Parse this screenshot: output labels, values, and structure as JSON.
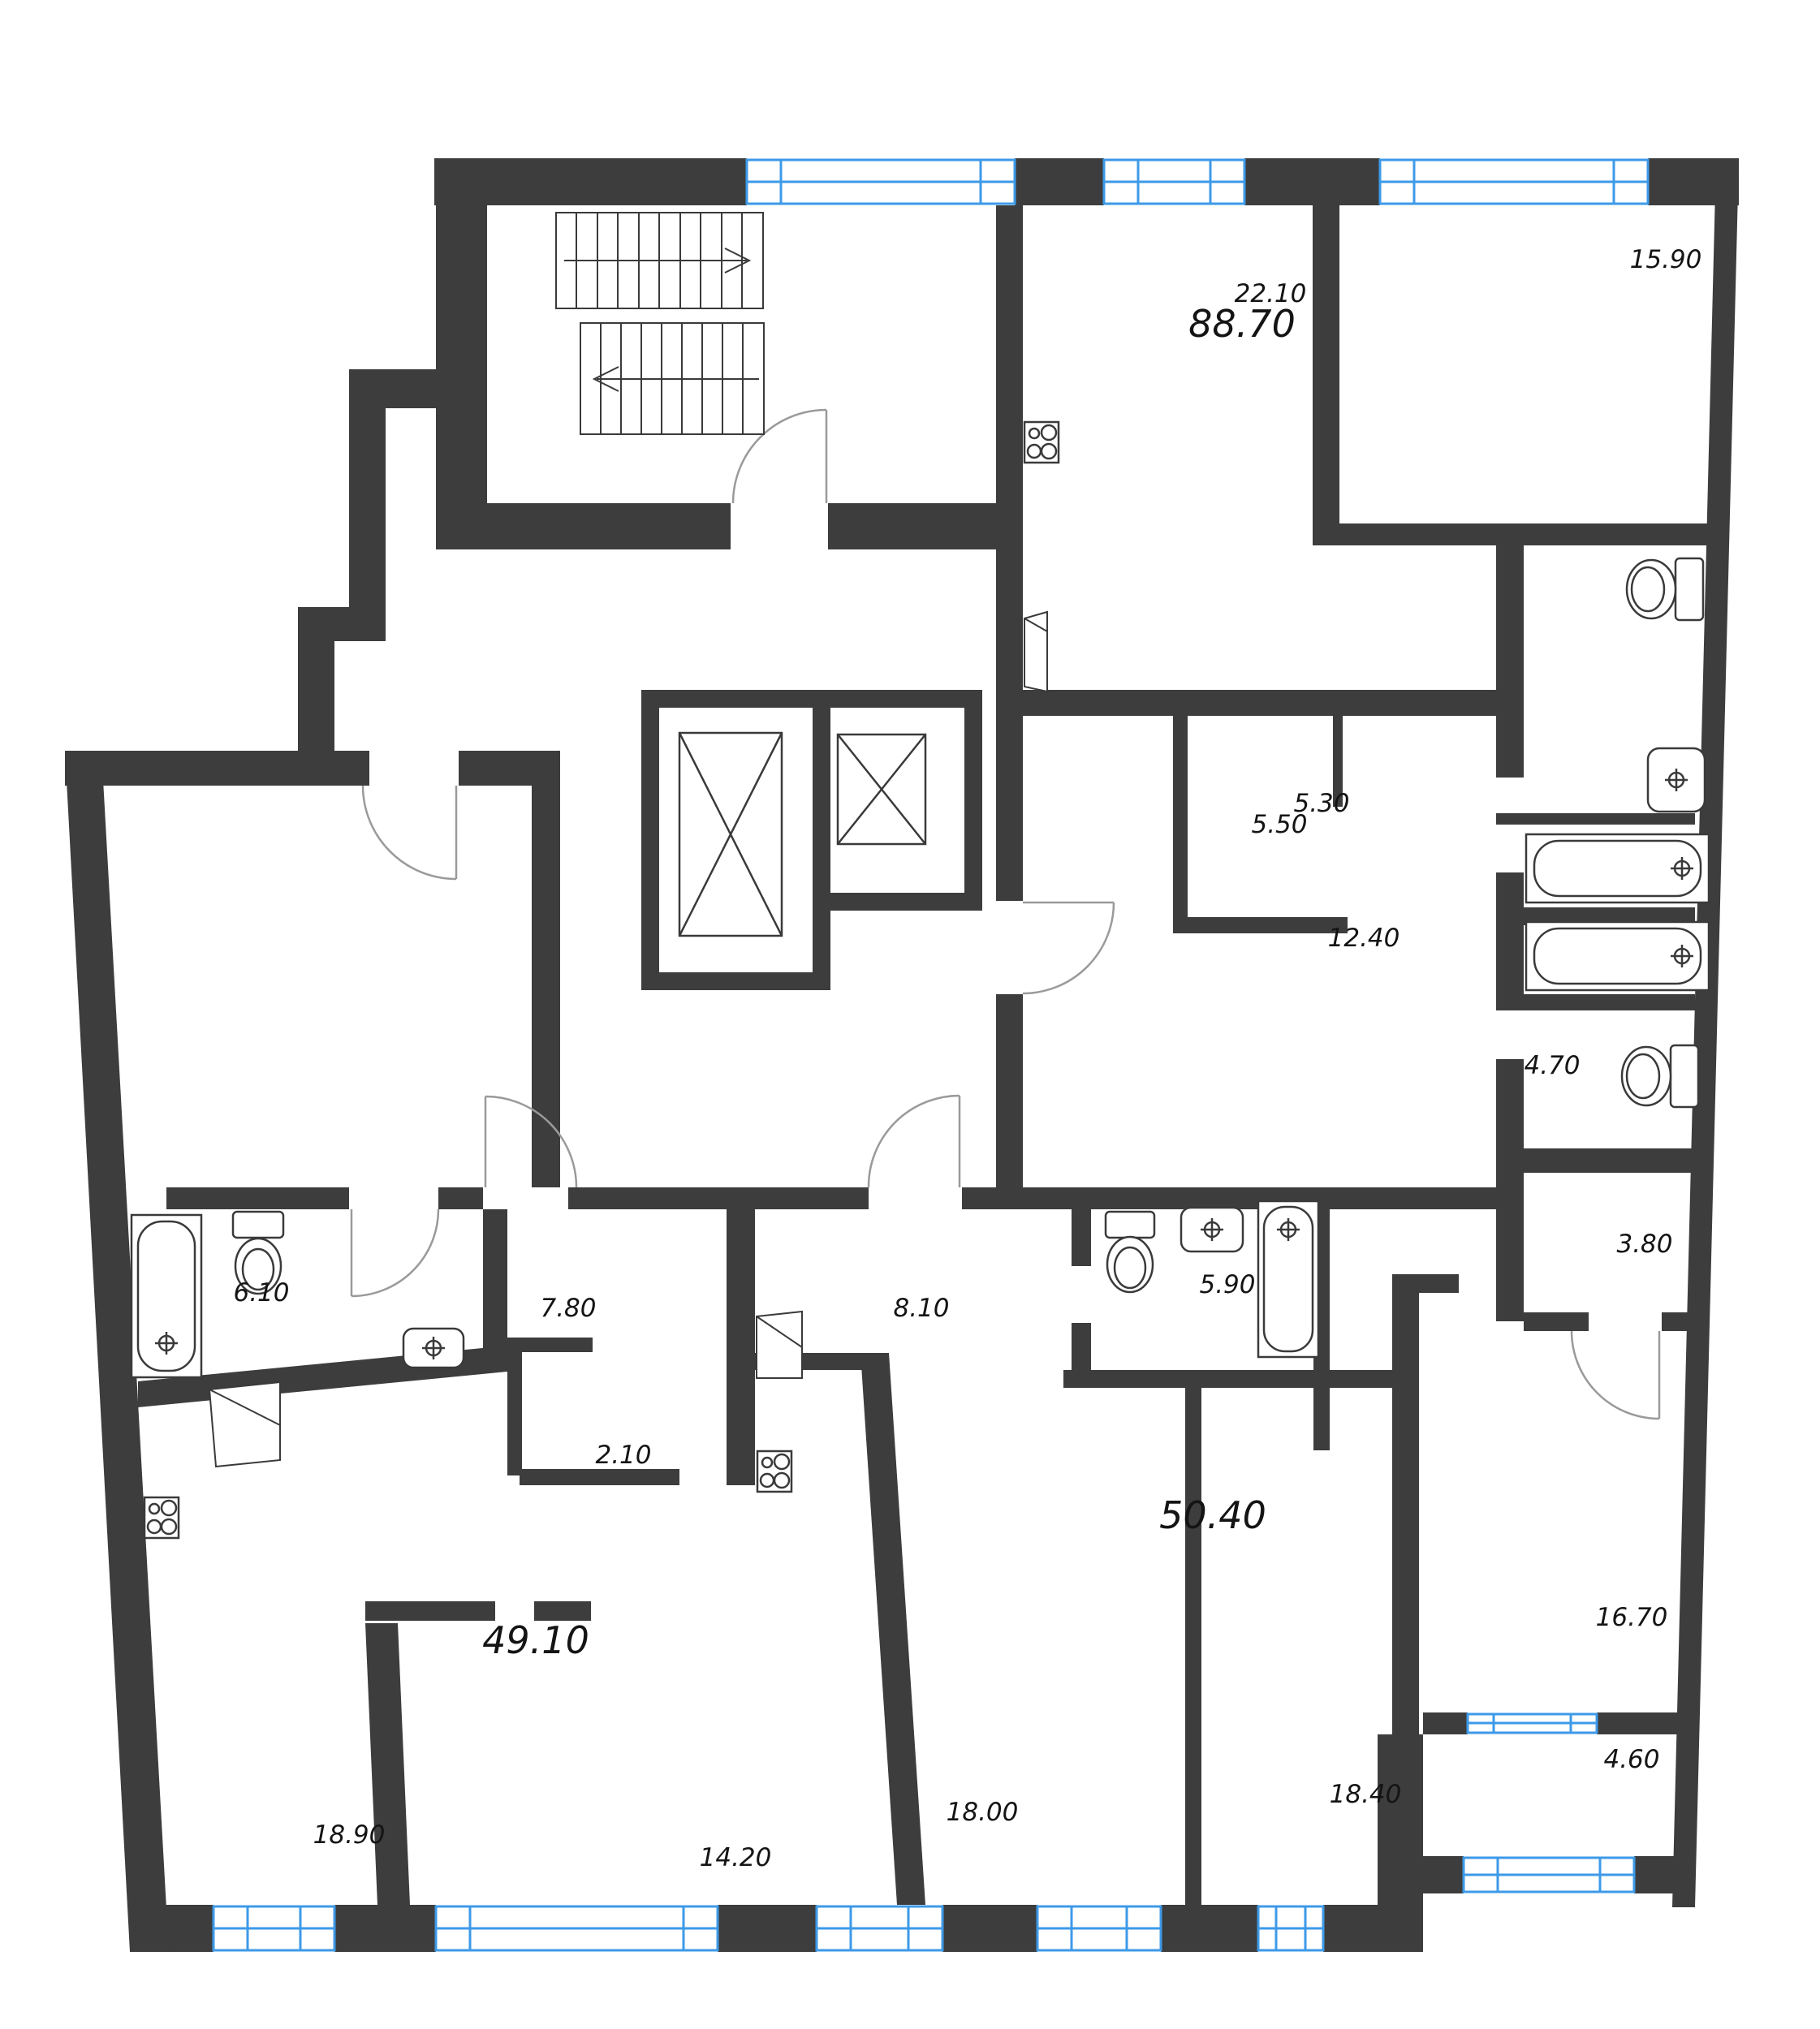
{
  "colors": {
    "wall": "#3d3d3d",
    "window": "#3d9ae8",
    "fixture": "#3a3a3a",
    "door": "#9a9a9a",
    "stair": "#4a4a4a",
    "text": "#141414",
    "background": "#ffffff"
  },
  "plan_type": "residential-floor-plan",
  "apartments": [
    {
      "total": "88.70",
      "rooms": [
        "22.10",
        "15.90",
        "5.50",
        "12.40",
        "5.30",
        "4.70",
        "3.80",
        "16.70",
        "4.60"
      ]
    },
    {
      "total": "49.10",
      "rooms": [
        "7.80",
        "6.10",
        "2.10",
        "18.90",
        "14.20"
      ]
    },
    {
      "total": "50.40",
      "rooms": [
        "8.10",
        "5.90",
        "18.00",
        "18.40"
      ]
    }
  ],
  "labels": {
    "a22_10": "22.10",
    "a88_70": "88.70",
    "a15_90": "15.90",
    "a5_50": "5.50",
    "a12_40": "12.40",
    "a5_30": "5.30",
    "a4_70": "4.70",
    "a3_80": "3.80",
    "a16_70": "16.70",
    "a4_60": "4.60",
    "a6_10": "6.10",
    "a7_80": "7.80",
    "a2_10": "2.10",
    "a49_10": "49.10",
    "a8_10": "8.10",
    "a5_90": "5.90",
    "a50_40": "50.40",
    "a18_90": "18.90",
    "a14_20": "14.20",
    "a18_00": "18.00",
    "a18_40": "18.40"
  },
  "icons": [
    "stairs-icon",
    "elevator-icon",
    "bathtub-icon",
    "toilet-icon",
    "sink-icon",
    "stove-icon",
    "wardrobe-icon",
    "door-arc-icon",
    "window-icon"
  ]
}
